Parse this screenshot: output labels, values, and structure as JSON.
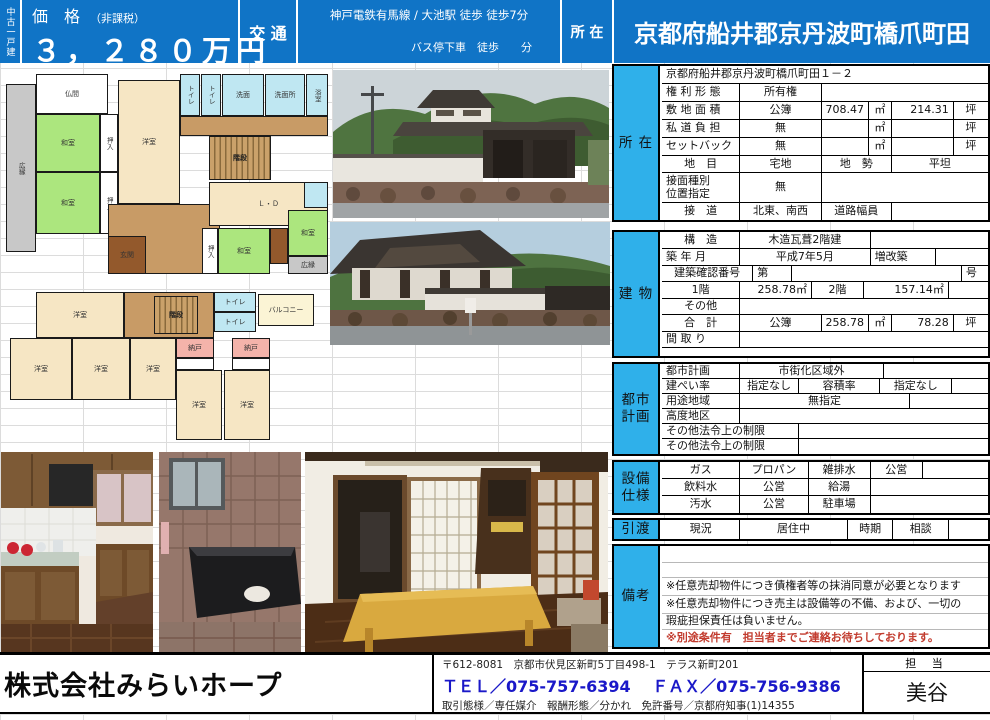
{
  "colors": {
    "header_blue": "#1074c6",
    "section_label_cyan": "#2fb0ea",
    "note_red": "#c23b2e",
    "tel_blue": "#1a18c8",
    "grid_line": "#dcdcdc"
  },
  "header": {
    "property_type": "中古一戸建",
    "price_label": "価　格",
    "price_tax_note": "（非課税）",
    "price_value": "３，２８０万円",
    "transport_label": "交 通",
    "transport_line1": "神戸電鉄有馬線 / 大池駅 徒歩 徒歩7分",
    "transport_line2": "バス停下車　徒歩　　分",
    "location_label": "所 在",
    "location_value": "京都府船井郡京丹波町橋爪町田"
  },
  "sections": [
    {
      "id": "shozai",
      "label": "所 在",
      "top": 64,
      "boxh": 158,
      "rows": [
        {
          "h": 18,
          "cells": [
            {
              "t": "京都府船井郡京丹波町橋爪町田１－２",
              "w": 100,
              "a": "left"
            }
          ]
        },
        {
          "h": 18,
          "cells": [
            {
              "t": "権 利 形 態",
              "w": 24,
              "a": "left"
            },
            {
              "t": "所有権",
              "w": 25,
              "a": "center"
            },
            {
              "t": "",
              "w": 51
            }
          ]
        },
        {
          "h": 18,
          "cells": [
            {
              "t": "敷 地 面 積",
              "w": 24,
              "a": "left"
            },
            {
              "t": "公簿",
              "w": 25,
              "a": "center"
            },
            {
              "t": "708.47",
              "w": 14.5,
              "a": "right"
            },
            {
              "t": "㎡",
              "w": 7,
              "a": "center"
            },
            {
              "t": "214.31",
              "w": 19,
              "a": "right"
            },
            {
              "t": "坪",
              "w": 10.5,
              "a": "center"
            }
          ]
        },
        {
          "h": 18,
          "cells": [
            {
              "t": "私 道 負 担",
              "w": 24,
              "a": "left"
            },
            {
              "t": "無",
              "w": 25,
              "a": "center"
            },
            {
              "t": "",
              "w": 14.5
            },
            {
              "t": "㎡",
              "w": 7,
              "a": "center"
            },
            {
              "t": "",
              "w": 19
            },
            {
              "t": "坪",
              "w": 10.5,
              "a": "center"
            }
          ]
        },
        {
          "h": 18,
          "cells": [
            {
              "t": "セットバック",
              "w": 24,
              "a": "left"
            },
            {
              "t": "無",
              "w": 25,
              "a": "center"
            },
            {
              "t": "",
              "w": 14.5
            },
            {
              "t": "㎡",
              "w": 7,
              "a": "center"
            },
            {
              "t": "",
              "w": 19
            },
            {
              "t": "坪",
              "w": 10.5,
              "a": "center"
            }
          ]
        },
        {
          "h": 17,
          "cells": [
            {
              "t": "地　目",
              "w": 24,
              "a": "center"
            },
            {
              "t": "宅地",
              "w": 25,
              "a": "center"
            },
            {
              "t": "地　勢",
              "w": 21.5,
              "a": "center"
            },
            {
              "t": "平坦",
              "w": 29.5,
              "a": "center"
            }
          ]
        },
        {
          "h": 30,
          "cells": [
            {
              "t": "接面種別\n位置指定",
              "w": 24,
              "a": "left"
            },
            {
              "t": "無",
              "w": 25,
              "a": "center"
            },
            {
              "t": "",
              "w": 51
            }
          ]
        },
        {
          "h": 17,
          "cells": [
            {
              "t": "接　道",
              "w": 24,
              "a": "center"
            },
            {
              "t": "北東、南西",
              "w": 25,
              "a": "center"
            },
            {
              "t": "道路幅員",
              "w": 21.5,
              "a": "center"
            },
            {
              "t": "",
              "w": 29.5
            }
          ]
        }
      ]
    },
    {
      "id": "tatemono",
      "label": "建 物",
      "top": 230,
      "boxh": 128,
      "rows": [
        {
          "h": 17,
          "cells": [
            {
              "t": "構　造",
              "w": 24,
              "a": "center"
            },
            {
              "t": "木造瓦葺2階建",
              "w": 40,
              "a": "center"
            },
            {
              "t": "",
              "w": 36
            }
          ]
        },
        {
          "h": 17,
          "cells": [
            {
              "t": "築 年 月",
              "w": 24,
              "a": "left"
            },
            {
              "t": "平成7年5月",
              "w": 40,
              "a": "center"
            },
            {
              "t": "増改築",
              "w": 20,
              "a": "left"
            },
            {
              "t": "",
              "w": 16
            }
          ]
        },
        {
          "h": 16,
          "cells": [
            {
              "t": "建築確認番号",
              "w": 28,
              "a": "center"
            },
            {
              "t": "第",
              "w": 12,
              "a": "left"
            },
            {
              "t": "",
              "w": 52
            },
            {
              "t": "号",
              "w": 8,
              "a": "left"
            }
          ]
        },
        {
          "h": 17,
          "cells": [
            {
              "t": "1階",
              "w": 24,
              "a": "center"
            },
            {
              "t": "258.78㎡",
              "w": 22,
              "a": "right"
            },
            {
              "t": "2階",
              "w": 16,
              "a": "center"
            },
            {
              "t": "157.14㎡",
              "w": 26,
              "a": "right"
            },
            {
              "t": "",
              "w": 12
            }
          ]
        },
        {
          "h": 16,
          "cells": [
            {
              "t": "その他",
              "w": 24,
              "a": "center"
            },
            {
              "t": "",
              "w": 76
            }
          ]
        },
        {
          "h": 17,
          "cells": [
            {
              "t": "合　計",
              "w": 24,
              "a": "center"
            },
            {
              "t": "公簿",
              "w": 25,
              "a": "center"
            },
            {
              "t": "258.78",
              "w": 14.5,
              "a": "right"
            },
            {
              "t": "㎡",
              "w": 7,
              "a": "center"
            },
            {
              "t": "78.28",
              "w": 19,
              "a": "right"
            },
            {
              "t": "坪",
              "w": 10.5,
              "a": "center"
            }
          ]
        },
        {
          "h": 16,
          "cells": [
            {
              "t": "間 取 り",
              "w": 24,
              "a": "left"
            },
            {
              "t": "",
              "w": 76
            }
          ]
        },
        {
          "h": 8,
          "cells": [
            {
              "t": "",
              "w": 100
            }
          ]
        }
      ]
    },
    {
      "id": "toshikeikaku",
      "label": "都市\n計画",
      "top": 362,
      "boxh": 94,
      "rows": [
        {
          "h": 15,
          "cells": [
            {
              "t": "都市計画",
              "w": 24,
              "a": "left"
            },
            {
              "t": "市街化区域外",
              "w": 44,
              "a": "center"
            },
            {
              "t": "",
              "w": 32
            }
          ]
        },
        {
          "h": 15,
          "cells": [
            {
              "t": "建ぺい率",
              "w": 24,
              "a": "left"
            },
            {
              "t": "指定なし",
              "w": 18,
              "a": "center"
            },
            {
              "t": "容積率",
              "w": 25,
              "a": "center"
            },
            {
              "t": "指定なし",
              "w": 22,
              "a": "center"
            },
            {
              "t": "",
              "w": 11
            }
          ]
        },
        {
          "h": 15,
          "cells": [
            {
              "t": "用途地域",
              "w": 24,
              "a": "left"
            },
            {
              "t": "無指定",
              "w": 52,
              "a": "center"
            },
            {
              "t": "",
              "w": 24
            }
          ]
        },
        {
          "h": 15,
          "cells": [
            {
              "t": "高度地区",
              "w": 24,
              "a": "left"
            },
            {
              "t": "",
              "w": 76
            }
          ]
        },
        {
          "h": 15,
          "cells": [
            {
              "t": "その他法令上の制限",
              "w": 42,
              "a": "left"
            },
            {
              "t": "",
              "w": 58
            }
          ]
        },
        {
          "h": 15,
          "cells": [
            {
              "t": "その他法令上の制限",
              "w": 42,
              "a": "left"
            },
            {
              "t": "",
              "w": 58
            }
          ]
        }
      ]
    },
    {
      "id": "setsubi",
      "label": "設備\n仕様",
      "top": 460,
      "boxh": 55,
      "rows": [
        {
          "h": 17,
          "cells": [
            {
              "t": "ガス",
              "w": 24,
              "a": "center"
            },
            {
              "t": "プロパン",
              "w": 21,
              "a": "center"
            },
            {
              "t": "雑排水",
              "w": 19,
              "a": "center"
            },
            {
              "t": "公営",
              "w": 16,
              "a": "center"
            },
            {
              "t": "",
              "w": 20
            }
          ]
        },
        {
          "h": 17,
          "cells": [
            {
              "t": "飲料水",
              "w": 24,
              "a": "center"
            },
            {
              "t": "公営",
              "w": 21,
              "a": "center"
            },
            {
              "t": "給湯",
              "w": 19,
              "a": "center"
            },
            {
              "t": "",
              "w": 36
            }
          ]
        },
        {
          "h": 17,
          "cells": [
            {
              "t": "汚水",
              "w": 24,
              "a": "center"
            },
            {
              "t": "公営",
              "w": 21,
              "a": "center"
            },
            {
              "t": "駐車場",
              "w": 19,
              "a": "center"
            },
            {
              "t": "",
              "w": 36
            }
          ]
        }
      ]
    },
    {
      "id": "hikiwatashi",
      "label": "引渡",
      "top": 518,
      "boxh": 23,
      "rows": [
        {
          "h": 19,
          "cells": [
            {
              "t": "現況",
              "w": 24,
              "a": "center"
            },
            {
              "t": "居住中",
              "w": 33,
              "a": "center"
            },
            {
              "t": "時期",
              "w": 14,
              "a": "center"
            },
            {
              "t": "相談",
              "w": 17,
              "a": "center"
            },
            {
              "t": "",
              "w": 12
            }
          ]
        }
      ]
    },
    {
      "id": "biko",
      "label": "備考",
      "top": 544,
      "boxh": 105,
      "light": true,
      "rows": [
        {
          "h": 17,
          "cells": [
            {
              "t": "",
              "w": 100
            }
          ]
        },
        {
          "h": 15,
          "cells": [
            {
              "t": "",
              "w": 100
            }
          ]
        },
        {
          "h": 18,
          "cells": [
            {
              "t": "※任意売却物件につき債権者等の抹消同意が必要となります",
              "w": 100,
              "a": "left"
            }
          ]
        },
        {
          "h": 18,
          "cells": [
            {
              "t": "※任意売却物件につき売主は設備等の不備、および、一切の",
              "w": 100,
              "a": "left"
            }
          ]
        },
        {
          "h": 16,
          "cells": [
            {
              "t": "瑕疵担保責任は負いません。",
              "w": 100,
              "a": "left"
            }
          ]
        },
        {
          "h": 17,
          "cells": [
            {
              "t": "※別途条件有　担当者までご連絡お待ちしております。",
              "w": 100,
              "a": "left",
              "red": true
            }
          ]
        }
      ]
    }
  ],
  "floorplan_palette": {
    "tatami": "#ace67e",
    "room": "#f6e6c4",
    "hall": "#c89b66",
    "genkan": "#93592c",
    "veranda": "#c8c8c8",
    "wet": "#bfe7f2",
    "closet": "#ffffff",
    "storage": "#f4b3aa",
    "balcony": "#fbf4d5"
  },
  "floorplans": [
    {
      "id": "floor-1",
      "left": 4,
      "top": 70,
      "width": 326,
      "height": 212,
      "rooms": [
        {
          "x": 2,
          "y": 14,
          "w": 30,
          "h": 168,
          "c": "veranda",
          "l": "広縁",
          "v": true
        },
        {
          "x": 32,
          "y": 4,
          "w": 72,
          "h": 40,
          "c": "closet",
          "l": "仏間"
        },
        {
          "x": 32,
          "y": 44,
          "w": 64,
          "h": 58,
          "c": "tatami",
          "l": "和室"
        },
        {
          "x": 32,
          "y": 102,
          "w": 64,
          "h": 62,
          "c": "tatami",
          "l": "和室"
        },
        {
          "x": 96,
          "y": 44,
          "w": 18,
          "h": 58,
          "c": "closet",
          "l": "押入",
          "v": true
        },
        {
          "x": 96,
          "y": 102,
          "w": 18,
          "h": 62,
          "c": "closet",
          "l": "押入",
          "v": true
        },
        {
          "x": 114,
          "y": 10,
          "w": 62,
          "h": 124,
          "c": "room",
          "l": "洋室"
        },
        {
          "x": 104,
          "y": 134,
          "w": 112,
          "h": 70,
          "c": "hall",
          "l": ""
        },
        {
          "x": 104,
          "y": 166,
          "w": 38,
          "h": 38,
          "c": "genkan",
          "l": "玄関"
        },
        {
          "x": 176,
          "y": 4,
          "w": 20,
          "h": 42,
          "c": "wet",
          "l": "トイレ",
          "v": true
        },
        {
          "x": 197,
          "y": 4,
          "w": 20,
          "h": 42,
          "c": "wet",
          "l": "トイレ",
          "v": true
        },
        {
          "x": 218,
          "y": 4,
          "w": 42,
          "h": 42,
          "c": "wet",
          "l": "洗面"
        },
        {
          "x": 261,
          "y": 4,
          "w": 40,
          "h": 42,
          "c": "wet",
          "l": "洗面所"
        },
        {
          "x": 302,
          "y": 4,
          "w": 22,
          "h": 42,
          "c": "wet",
          "l": "浴室",
          "v": true
        },
        {
          "x": 176,
          "y": 46,
          "w": 148,
          "h": 20,
          "c": "hall",
          "l": ""
        },
        {
          "x": 205,
          "y": 66,
          "w": 62,
          "h": 44,
          "c": "stairs",
          "l": "階段"
        },
        {
          "x": 205,
          "y": 112,
          "w": 119,
          "h": 44,
          "c": "room",
          "l": "Ｌ・Ｄ"
        },
        {
          "x": 300,
          "y": 112,
          "w": 24,
          "h": 26,
          "c": "wet",
          "l": ""
        },
        {
          "x": 198,
          "y": 158,
          "w": 16,
          "h": 46,
          "c": "closet",
          "l": "押入",
          "v": true
        },
        {
          "x": 214,
          "y": 158,
          "w": 52,
          "h": 46,
          "c": "tatami",
          "l": "和室"
        },
        {
          "x": 266,
          "y": 158,
          "w": 18,
          "h": 36,
          "c": "genkan",
          "l": ""
        },
        {
          "x": 284,
          "y": 140,
          "w": 40,
          "h": 46,
          "c": "tatami",
          "l": "和室"
        },
        {
          "x": 284,
          "y": 186,
          "w": 40,
          "h": 18,
          "c": "veranda",
          "l": "広縁"
        }
      ]
    },
    {
      "id": "floor-2",
      "left": 8,
      "top": 290,
      "width": 308,
      "height": 152,
      "rooms": [
        {
          "x": 28,
          "y": 2,
          "w": 88,
          "h": 46,
          "c": "room",
          "l": "洋室"
        },
        {
          "x": 116,
          "y": 2,
          "w": 90,
          "h": 46,
          "c": "hall",
          "l": ""
        },
        {
          "x": 146,
          "y": 6,
          "w": 44,
          "h": 38,
          "c": "stairs",
          "l": "階段"
        },
        {
          "x": 206,
          "y": 2,
          "w": 42,
          "h": 20,
          "c": "wet",
          "l": "トイレ"
        },
        {
          "x": 206,
          "y": 22,
          "w": 42,
          "h": 20,
          "c": "wet",
          "l": "トイレ"
        },
        {
          "x": 250,
          "y": 4,
          "w": 56,
          "h": 32,
          "c": "balcony",
          "l": "バルコニー"
        },
        {
          "x": 2,
          "y": 48,
          "w": 62,
          "h": 62,
          "c": "room",
          "l": "洋室"
        },
        {
          "x": 64,
          "y": 48,
          "w": 58,
          "h": 62,
          "c": "room",
          "l": "洋室"
        },
        {
          "x": 122,
          "y": 48,
          "w": 46,
          "h": 62,
          "c": "room",
          "l": "洋室"
        },
        {
          "x": 168,
          "y": 48,
          "w": 38,
          "h": 20,
          "c": "storage",
          "l": "納戸"
        },
        {
          "x": 224,
          "y": 48,
          "w": 38,
          "h": 20,
          "c": "storage",
          "l": "納戸"
        },
        {
          "x": 168,
          "y": 68,
          "w": 38,
          "h": 12,
          "c": "closet",
          "l": ""
        },
        {
          "x": 224,
          "y": 68,
          "w": 38,
          "h": 12,
          "c": "closet",
          "l": ""
        },
        {
          "x": 168,
          "y": 80,
          "w": 46,
          "h": 70,
          "c": "room",
          "l": "洋室"
        },
        {
          "x": 216,
          "y": 80,
          "w": 46,
          "h": 70,
          "c": "room",
          "l": "洋室"
        }
      ]
    }
  ],
  "footer": {
    "company": "株式会社みらいホープ",
    "address": "〒612-8081　京都市伏見区新町5丁目498-1　テラス新町201",
    "tel_fax": "ＴＥＬ／075-757-6394　 ＦＡＸ／075-756-9386",
    "license": "取引態様／専任媒介　報酬形態／分かれ　免許番号／京都府知事(1)14355",
    "staff_label": "担 当",
    "staff_name": "美谷"
  }
}
